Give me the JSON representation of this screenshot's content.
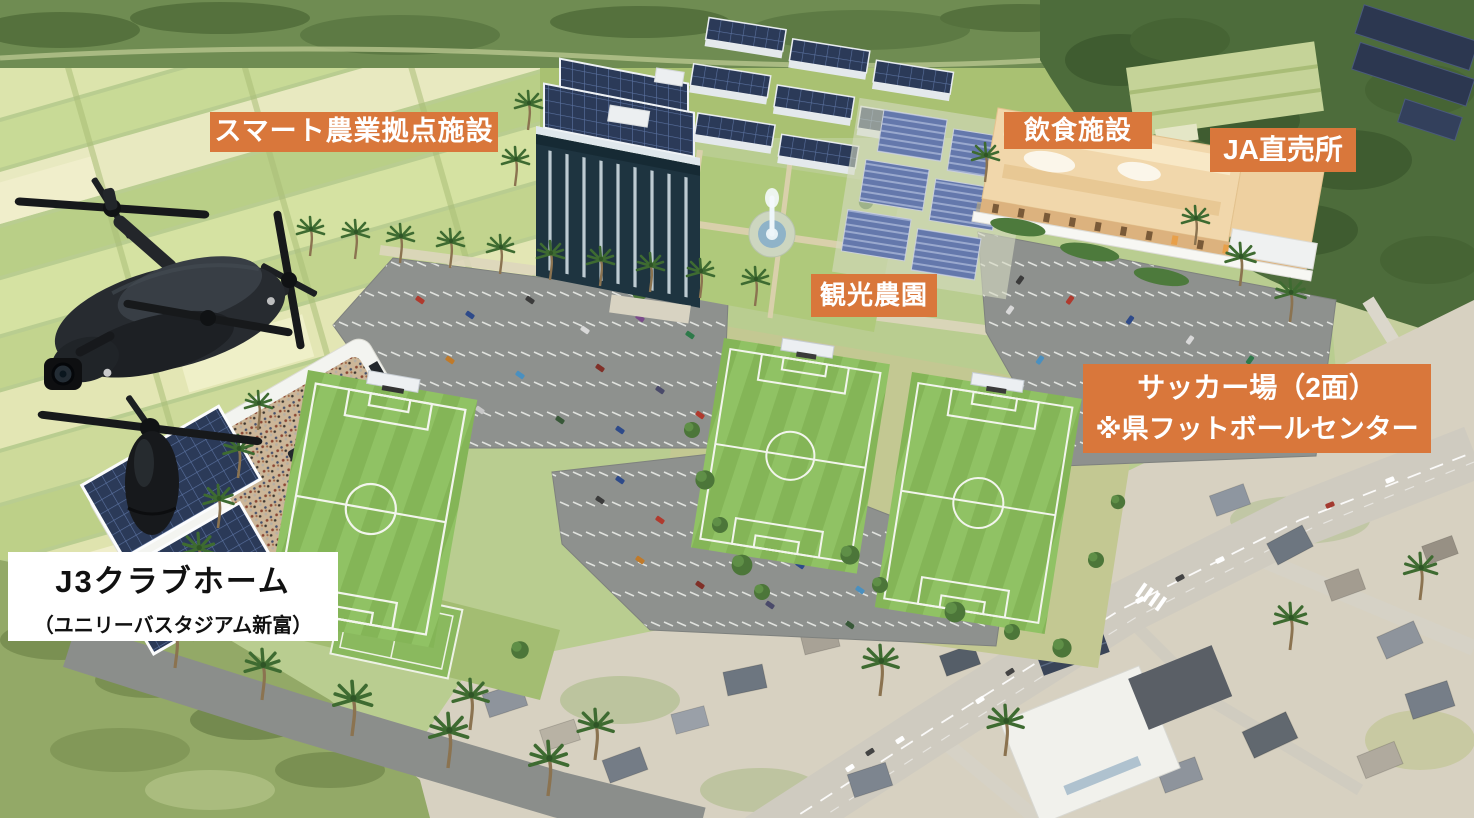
{
  "annotations": {
    "smart_agri": {
      "label": "スマート農業拠点施設"
    },
    "dining": {
      "label": "飲食施設"
    },
    "ja_shop": {
      "label": "JA直売所"
    },
    "tourist_farm": {
      "label": "観光農園"
    },
    "soccer_fields": {
      "line1": "サッカー場（2面）",
      "line2": "※県フットボールセンター"
    },
    "stadium": {
      "line1": "J3クラブホーム",
      "line2": "（ユニリーバスタジアム新富）"
    }
  },
  "colors": {
    "annotation_bg": "#D9773B",
    "annotation_text": "#FFFFFF",
    "stadium_annotation_bg": "#FFFFFF",
    "stadium_annotation_text": "#111111"
  }
}
